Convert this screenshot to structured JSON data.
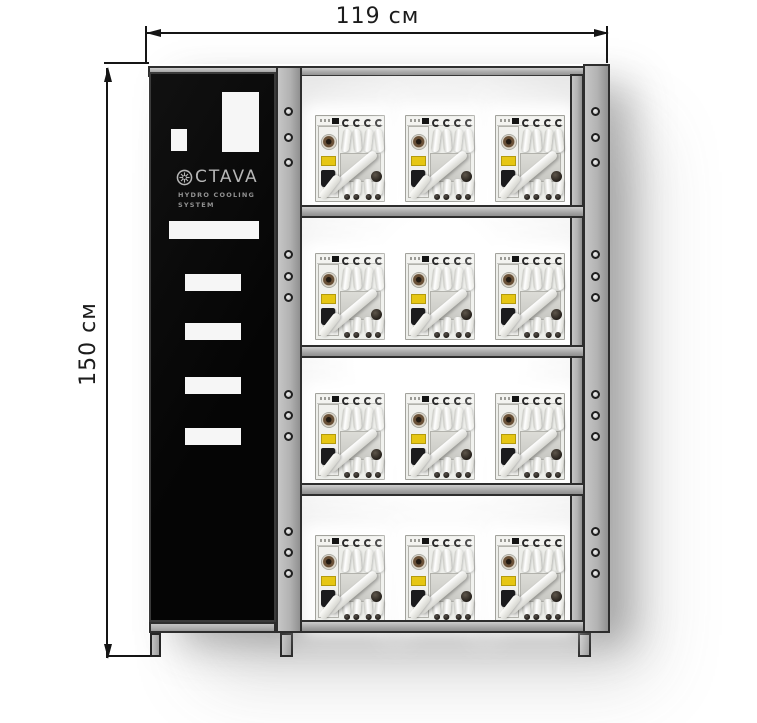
{
  "dimensions": {
    "width_label": "119 см",
    "height_label": "150 см"
  },
  "panel": {
    "brand": "CTAVA",
    "logo_icon": "octava-rosette",
    "tagline_line1": "HYDRO COOLING",
    "tagline_line2": "SYSTEM"
  },
  "rack": {
    "shelf_count": 4,
    "units_per_shelf": 3
  },
  "colors": {
    "frame_gray": "#b2b2b2",
    "panel_black": "#0a0a0a",
    "unit_label_yellow": "#e6c614",
    "dimension_line": "#151515"
  }
}
